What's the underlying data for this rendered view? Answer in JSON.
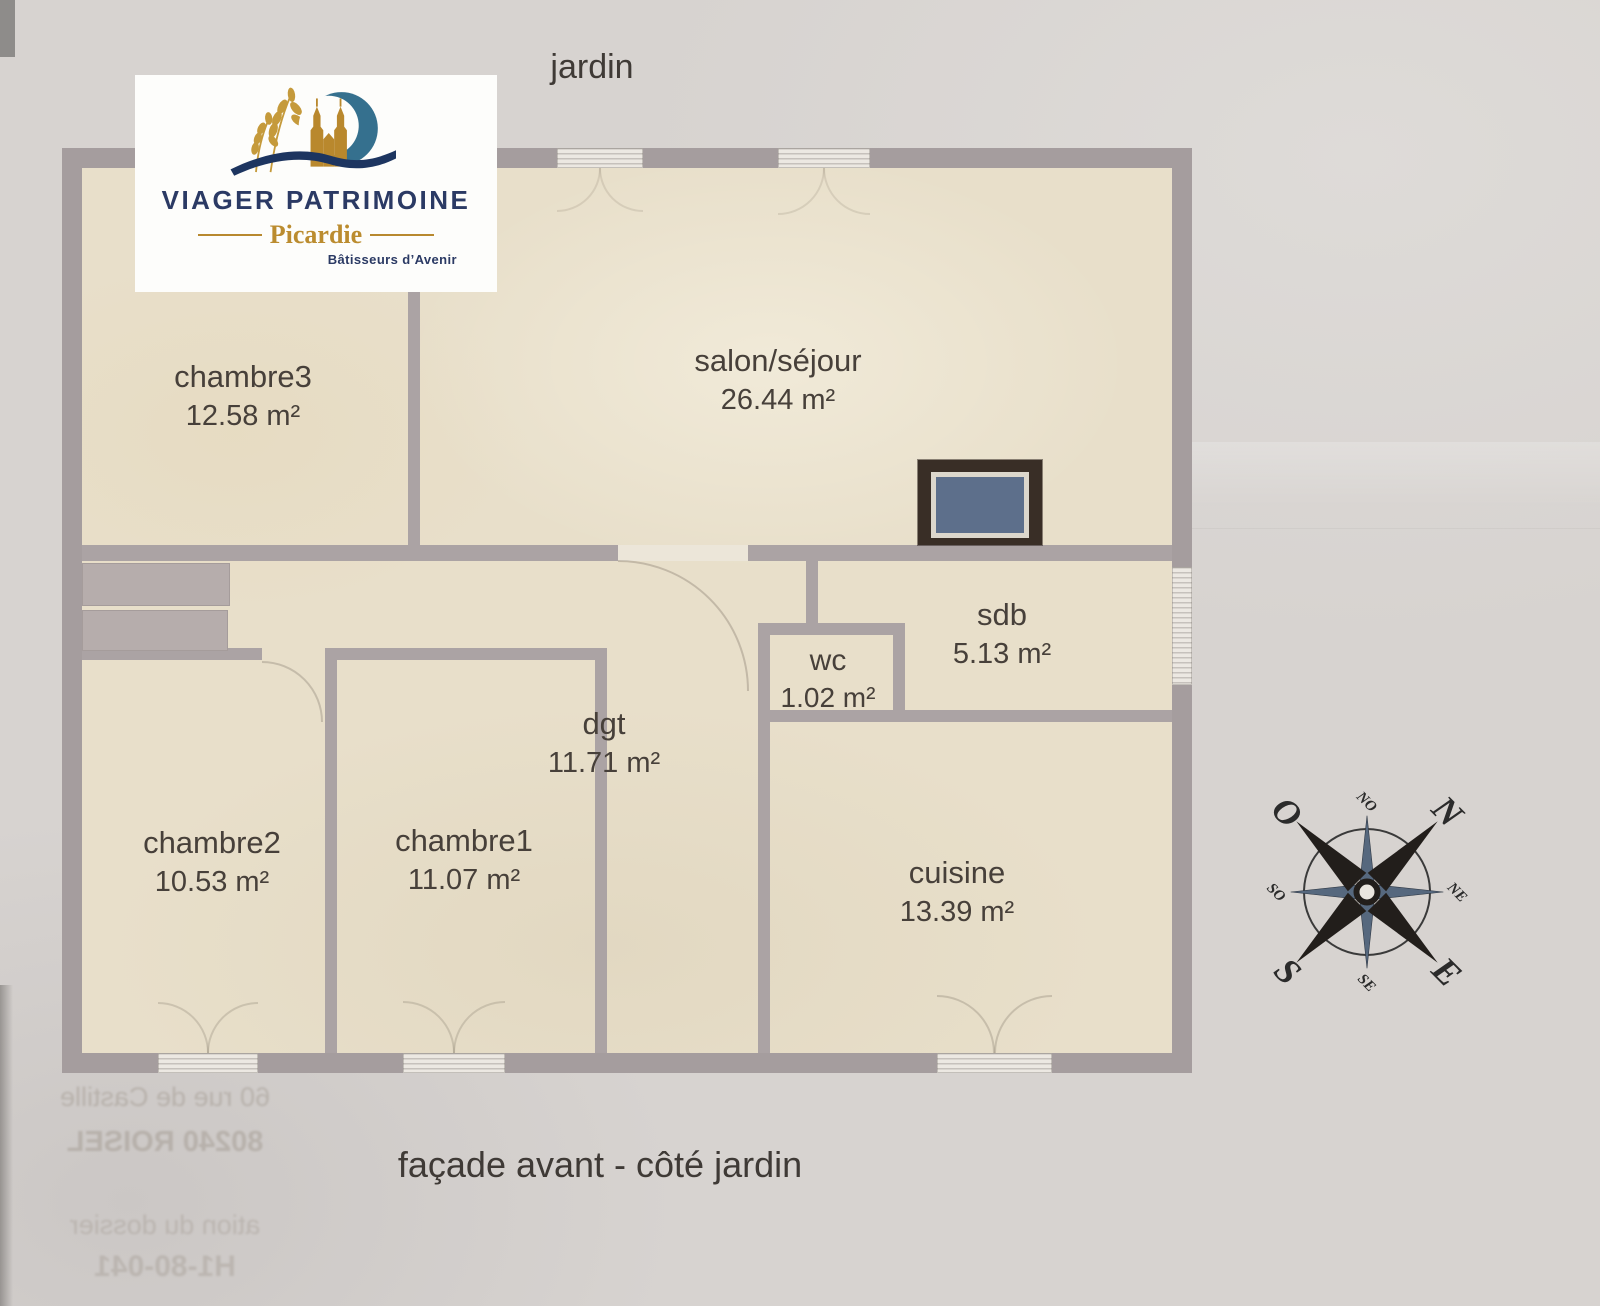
{
  "page": {
    "top_label": "jardin",
    "bottom_label": "façade avant - côté jardin"
  },
  "logo": {
    "title": "VIAGER PATRIMOINE",
    "region": "Picardie",
    "tagline": "Bâtisseurs d’Avenir"
  },
  "rooms": [
    {
      "name": "chambre3",
      "area": "12.58 m²"
    },
    {
      "name": "salon/séjour",
      "area": "26.44 m²"
    },
    {
      "name": "sdb",
      "area": "5.13 m²"
    },
    {
      "name": "wc",
      "area": "1.02 m²"
    },
    {
      "name": "dgt",
      "area": "11.71 m²"
    },
    {
      "name": "chambre2",
      "area": "10.53 m²"
    },
    {
      "name": "chambre1",
      "area": "11.07 m²"
    },
    {
      "name": "cuisine",
      "area": "13.39 m²"
    }
  ],
  "compass": {
    "n": "N",
    "e": "E",
    "s": "S",
    "o": "O",
    "no": "NO",
    "ne": "NE",
    "se": "SE",
    "so": "SO"
  },
  "bleed_through": {
    "line1": "60 rue de Castille",
    "line2": "80240 ROISEL",
    "line3": "ation du dossier",
    "line4": "H1-80-041"
  },
  "colors": {
    "paper": "#d7d3d0",
    "room_fill": "#e8dfca",
    "wall": "#a59d9e",
    "window": "#ece8e2",
    "stove_frame": "#392e26",
    "stove_blue": "#5d6f8b",
    "logo_navy": "#2b3a64",
    "logo_gold": "#bb8c2f",
    "logo_blue": "#35708e"
  }
}
